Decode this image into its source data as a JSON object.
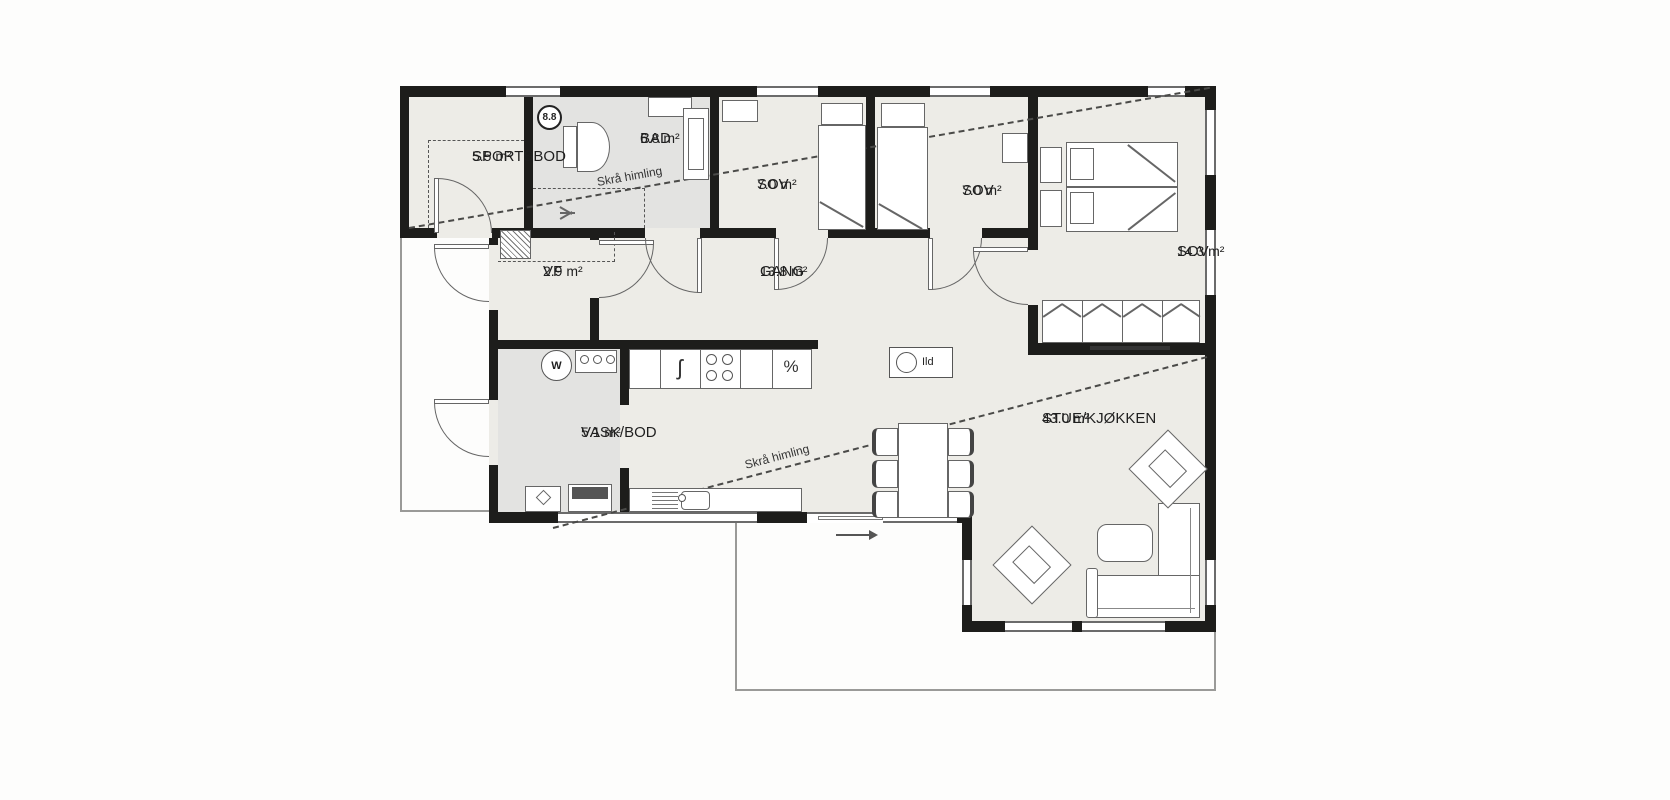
{
  "rooms": {
    "sportsbod": {
      "name": "SPORTSBOD",
      "area": "5.5 m²"
    },
    "bad": {
      "name": "BAD",
      "area": "6.8 m²"
    },
    "sov1": {
      "name": "SOV",
      "area": "7.0 m²"
    },
    "sov2": {
      "name": "SOV",
      "area": "7.0 m²"
    },
    "sov3": {
      "name": "SOV",
      "area": "14.3 m²"
    },
    "vf": {
      "name": "VF",
      "area": "2.9 m²"
    },
    "gang": {
      "name": "GANG",
      "area": "13.8 m²"
    },
    "vask": {
      "name": "VASK/BOD",
      "area": "5.1 m²"
    },
    "stue": {
      "name": "STUE/KJØKKEN",
      "area": "43.0 m²"
    }
  },
  "annotations": {
    "sloped_ceiling_1": "Skrå himling",
    "sloped_ceiling_2": "Skrå himling",
    "fireplace_label": "Ild",
    "measure_marker": "8.8"
  },
  "symbols": {
    "washing_machine": "W",
    "dishwasher": "%",
    "fridge": "ʃ"
  },
  "colors": {
    "wall": "#1d1d1b",
    "floor": "#edece7",
    "wet_room_floor": "#e3e3e1",
    "outline": "#666666"
  }
}
